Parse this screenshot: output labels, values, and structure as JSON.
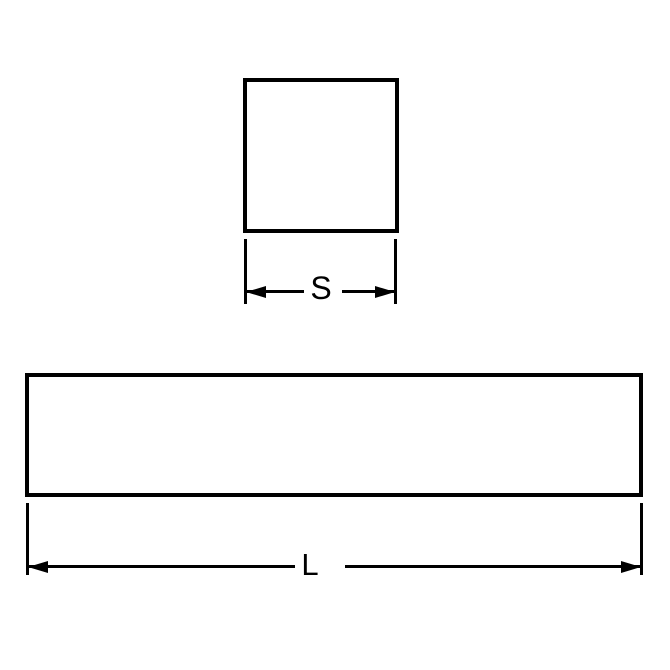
{
  "colors": {
    "background": "#ffffff",
    "line": "#000000"
  },
  "diagram": {
    "square_section": {
      "dimension_label": "S"
    },
    "bar_length": {
      "dimension_label": "L"
    }
  }
}
